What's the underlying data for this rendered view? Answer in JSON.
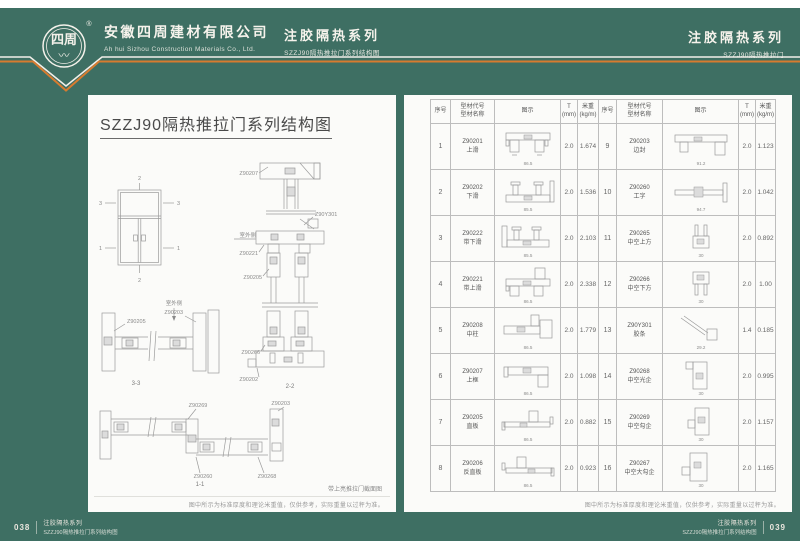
{
  "colors": {
    "background_green": "#3E6F63",
    "accent_orange": "#D77B2F",
    "page_white": "#FBFBF9"
  },
  "header": {
    "logo_text": "四周",
    "logo_reg": "®",
    "company_cn": "安徽四周建材有限公司",
    "company_en": "Ah hui Sizhou Construction Materials Co., Ltd.",
    "series_mid": {
      "title": "注胶隔热系列",
      "subtitle": "SZZJ90隔热推拉门系列结构图"
    },
    "series_right": {
      "title": "注胶隔热系列",
      "subtitle": "SZZJ90隔热推拉门"
    }
  },
  "left_page": {
    "title": "SZZJ90隔热推拉门系列结构图",
    "elevation": {
      "m_top": "2",
      "m_ul": "3",
      "m_ur": "3",
      "m_ll": "1",
      "m_lr": "1",
      "m_bot": "2"
    },
    "section_22": {
      "l_head": "Z90207",
      "l_corner": "Z90Y301",
      "l_band": "Z90221",
      "l_sash_top": "Z90205",
      "l_sash_bottom": "Z90266",
      "l_track": "Z90202",
      "outdoor": "室外侧",
      "caption": "2-2"
    },
    "section_33": {
      "label_left": "Z90205",
      "label_right": "Z90203",
      "outdoor": "室外侧",
      "caption": "3-3"
    },
    "section_11": {
      "l_tl": "Z90269",
      "l_tr": "Z90203",
      "l_bl": "Z90260",
      "l_br": "Z90268",
      "caption": "1-1"
    },
    "drawing_caption": "带上亮推拉门截面图",
    "note": "图中所示为标准厚度和理论米重值，仅供参考，实际重量以过秤为准。"
  },
  "right_page": {
    "table": {
      "headers": {
        "no": "序号",
        "code1": "型材代号",
        "code2": "型材名称",
        "diagram": "图示",
        "t1": "T",
        "t2": "(mm)",
        "w1": "米重",
        "w2": "(kg/m)"
      },
      "rows_left": [
        {
          "no": "1",
          "code": "Z90201",
          "name": "上滑",
          "t": "2.0",
          "weight": "1.674",
          "dim": "86.5",
          "shape": "top-track"
        },
        {
          "no": "2",
          "code": "Z90202",
          "name": "下滑",
          "t": "2.0",
          "weight": "1.536",
          "dim": "85.5",
          "shape": "bottom-track"
        },
        {
          "no": "3",
          "code": "Z90222",
          "name": "带下滑",
          "t": "2.0",
          "weight": "2.103",
          "dim": "85.5",
          "shape": "band-bottom"
        },
        {
          "no": "4",
          "code": "Z90221",
          "name": "带上滑",
          "t": "2.0",
          "weight": "2.338",
          "dim": "86.5",
          "shape": "band-top"
        },
        {
          "no": "5",
          "code": "Z90208",
          "name": "中柱",
          "t": "2.0",
          "weight": "1.779",
          "dim": "86.5",
          "shape": "mid-post"
        },
        {
          "no": "6",
          "code": "Z90207",
          "name": "上框",
          "t": "2.0",
          "weight": "1.098",
          "dim": "86.5",
          "shape": "head"
        },
        {
          "no": "7",
          "code": "Z90205",
          "name": "直板",
          "t": "2.0",
          "weight": "0.882",
          "dim": "86.5",
          "shape": "flat"
        },
        {
          "no": "8",
          "code": "Z90206",
          "name": "反直板",
          "t": "2.0",
          "weight": "0.923",
          "dim": "86.5",
          "shape": "flat-r"
        }
      ],
      "rows_right": [
        {
          "no": "9",
          "code": "Z90203",
          "name": "边封",
          "t": "2.0",
          "weight": "1.123",
          "dim": "91.2",
          "shape": "edge-seal"
        },
        {
          "no": "10",
          "code": "Z90260",
          "name": "工字",
          "t": "2.0",
          "weight": "1.042",
          "dim": "94.7",
          "shape": "i-bar"
        },
        {
          "no": "11",
          "code": "Z90265",
          "name": "中空上方",
          "t": "2.0",
          "weight": "0.892",
          "dim": "30",
          "shape": "v-top"
        },
        {
          "no": "12",
          "code": "Z90266",
          "name": "中空下方",
          "t": "2.0",
          "weight": "1.00",
          "dim": "30",
          "shape": "v-bottom"
        },
        {
          "no": "13",
          "code": "Z90Y301",
          "name": "胶条",
          "t": "1.4",
          "weight": "0.185",
          "dim": "29.2",
          "shape": "strip"
        },
        {
          "no": "14",
          "code": "Z90268",
          "name": "中空光企",
          "t": "2.0",
          "weight": "0.995",
          "dim": "30",
          "shape": "v-light"
        },
        {
          "no": "15",
          "code": "Z90269",
          "name": "中空勾企",
          "t": "2.0",
          "weight": "1.157",
          "dim": "30",
          "shape": "v-hook"
        },
        {
          "no": "16",
          "code": "Z90267",
          "name": "中空大勾企",
          "t": "2.0",
          "weight": "1.165",
          "dim": "30",
          "shape": "v-bighook"
        }
      ]
    },
    "note": "图中所示为标准厚度和理论米重值，仅供参考，实际重量以过秤为准。"
  },
  "footer": {
    "left": {
      "page": "038",
      "line1": "注胶隔热系列",
      "line2": "SZZJ90隔热推拉门系列结构图"
    },
    "right": {
      "page": "039",
      "line1": "注胶隔热系列",
      "line2": "SZZJ90隔热推拉门系列结构图"
    }
  }
}
